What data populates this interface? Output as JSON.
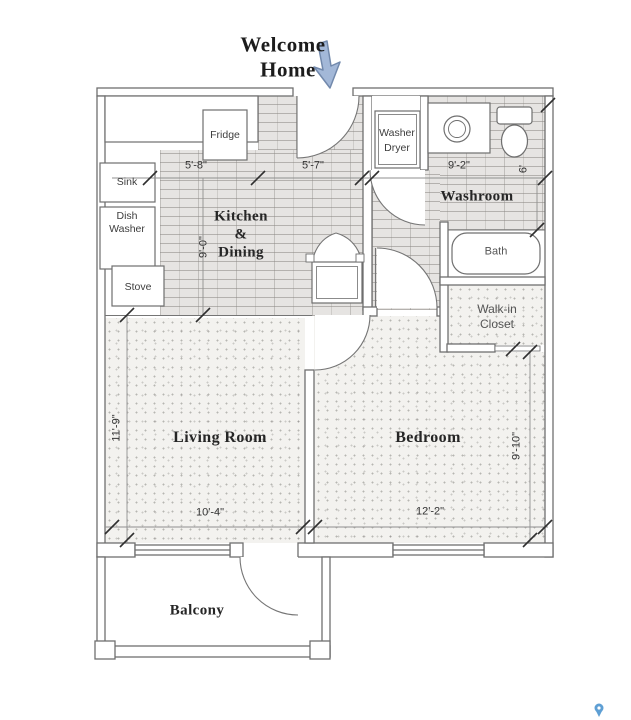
{
  "title": {
    "line1": "Welcome",
    "line2": "Home"
  },
  "rooms": {
    "kitchen_dining": {
      "line1": "Kitchen",
      "line2": "&",
      "line3": "Dining"
    },
    "washroom": "Washroom",
    "living_room": "Living Room",
    "bedroom": "Bedroom",
    "balcony": "Balcony",
    "walk_in_closet": {
      "line1": "Walk-in",
      "line2": "Closet"
    },
    "bath": "Bath"
  },
  "fixtures": {
    "fridge": "Fridge",
    "sink": "Sink",
    "dish_washer": {
      "line1": "Dish",
      "line2": "Washer"
    },
    "stove": "Stove",
    "washer_dryer": {
      "line1": "Washer",
      "line2": "Dryer"
    }
  },
  "dimensions": {
    "kitchen_width": "5'-8\"",
    "entry_width": "5'-7\"",
    "washroom_width": "9'-2\"",
    "kitchen_depth": "9'-0\"",
    "washroom_depth": "6'",
    "living_depth": "11'-9\"",
    "living_width": "10'-4\"",
    "bedroom_width": "12'-2\"",
    "bedroom_depth": "9'-10\""
  },
  "icons": {
    "entry_arrow": "down-arrow",
    "corner_pin": "map-pin"
  },
  "colors": {
    "wall": "#6f6f6f",
    "hatch_base": "#e6e4e2",
    "stipple_base": "#f3f2ef",
    "arrow_fill": "#a3b8d8",
    "arrow_stroke": "#7289ac",
    "pin": "#5e9fd4"
  }
}
